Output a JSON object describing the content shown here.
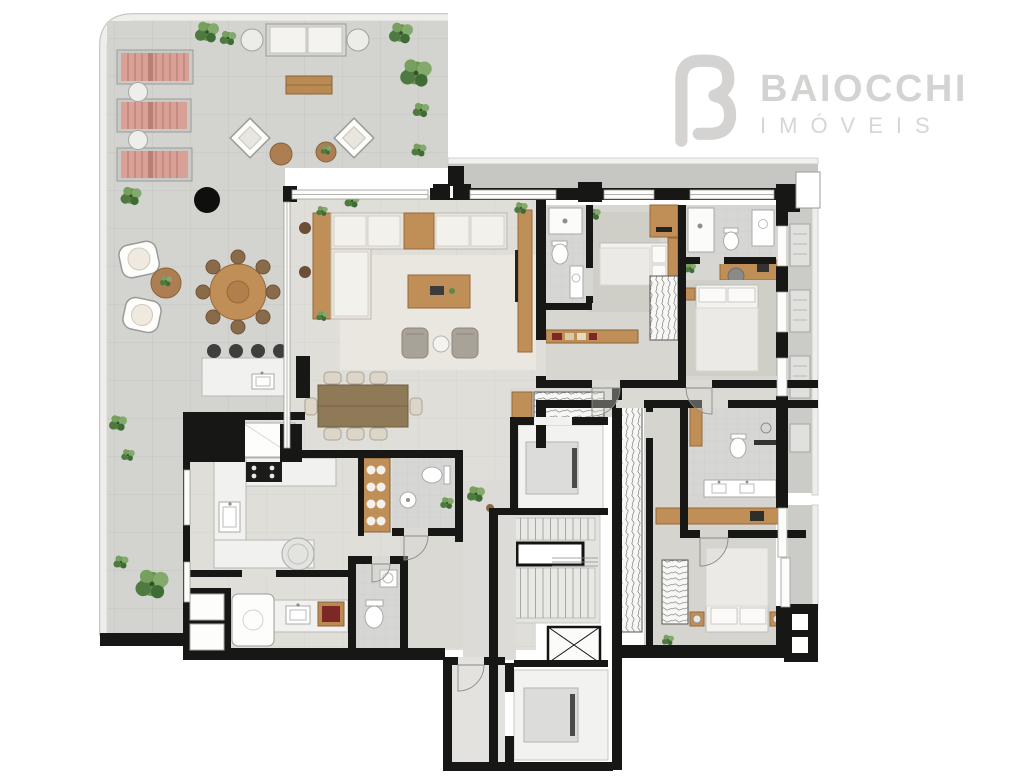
{
  "brand": {
    "logo_text": "BAIOCCHI",
    "logo_subtext": "IMÓVEIS",
    "logo_color": "#d4d3d1",
    "logo_mark": "stylized-rounded-B"
  },
  "palette": {
    "background": "#ffffff",
    "wall_black": "#171716",
    "terrace_floor": "#d3d4d0",
    "terrace_grid": "#c4c5c1",
    "indoor_floor": "#dfded9",
    "bedroom_floor": "#d7d6d1",
    "bathroom_floor": "#d6d7d4",
    "rug": "#cfcec7",
    "rug_cream": "#eae7e1",
    "wood": "#c08e57",
    "wood_dark": "#8f7a58",
    "sofa_cream": "#e9e5de",
    "armchair_taupe": "#a8a298",
    "lounger_pink": "#d8a096",
    "plant_green": "#5b8a50",
    "accent_dark_red": "#7e2727",
    "concrete_ledge": "#c6c6c3",
    "elevator_car": "#dcdcda",
    "parapet": "#efeeeb"
  },
  "floorplan": {
    "type": "residential-apartment-floor-plan",
    "rooms": [
      "terrace",
      "sun-deck",
      "outdoor-lounge",
      "outdoor-dining",
      "bar-counter",
      "living-room",
      "dining-area",
      "kitchen",
      "laundry-service",
      "powder-room",
      "wc",
      "hall",
      "suite-1",
      "suite-1-bathroom",
      "suite-2",
      "suite-2-bathroom",
      "master-suite",
      "master-bathroom",
      "walk-in-closet",
      "private-elevator",
      "social-elevator",
      "stairs",
      "elevator-shaft",
      "tech-balcony",
      "master-balcony"
    ],
    "furniture": [
      "sun-lounger",
      "side-table",
      "outdoor-sofa",
      "pouf",
      "coffee-table",
      "lounge-chair",
      "fire-pit",
      "round-dining-table",
      "bar-stool",
      "l-shaped-sofa",
      "tv-console",
      "dining-table-8",
      "cooktop",
      "sink",
      "fridge-tower",
      "wine-panel",
      "toilet",
      "shower",
      "vanity",
      "bed",
      "nightstand",
      "desk",
      "wardrobe",
      "washer",
      "ac-unit",
      "plant"
    ]
  }
}
